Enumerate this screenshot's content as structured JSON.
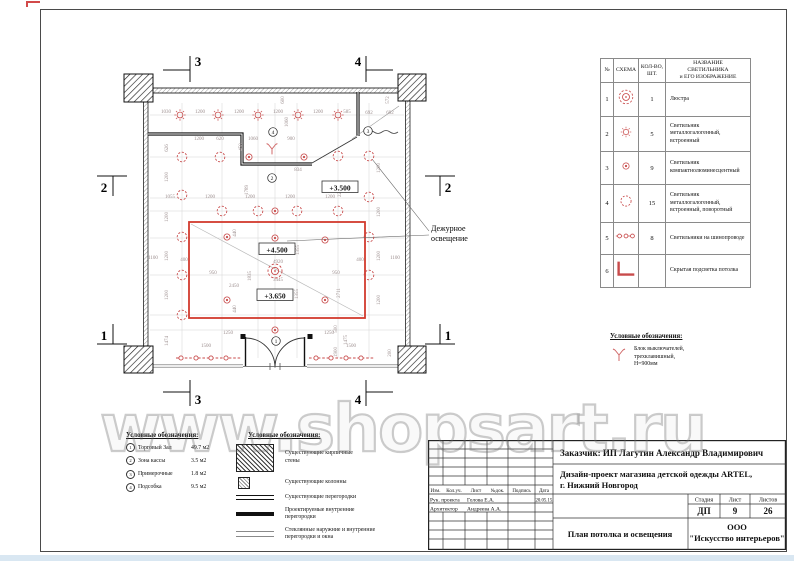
{
  "watermark": {
    "text": "www.shopsart.ru"
  },
  "colors": {
    "light_red": "#c84b4b",
    "cove_red": "#d23a2e",
    "dim_gray": "#9d8f8f",
    "wall_black": "#1a1a1a"
  },
  "plan": {
    "elevations": [
      {
        "t": "+3.500",
        "x": 340,
        "y": 189
      },
      {
        "t": "+4.500",
        "x": 277,
        "y": 251
      },
      {
        "t": "+3.650",
        "x": 275,
        "y": 297
      }
    ],
    "annotation": {
      "lines": [
        "Дежурное",
        "освещение"
      ],
      "x": 431,
      "y": 231
    },
    "room_tags": [
      {
        "n": "4",
        "x": 273,
        "y": 132
      },
      {
        "n": "2",
        "x": 272,
        "y": 178
      },
      {
        "n": "3",
        "x": 368,
        "y": 131
      },
      {
        "n": "1",
        "x": 276,
        "y": 341
      }
    ],
    "section_markers": [
      {
        "label": "3",
        "lines": [
          [
            163,
            70,
            190,
            70
          ],
          [
            190,
            56,
            190,
            82
          ]
        ],
        "tx": 198,
        "ty": 66
      },
      {
        "label": "4",
        "lines": [
          [
            393,
            70,
            366,
            70
          ],
          [
            366,
            56,
            366,
            82
          ]
        ],
        "tx": 358,
        "ty": 66
      },
      {
        "label": "3",
        "lines": [
          [
            163,
            392,
            190,
            392
          ],
          [
            190,
            380,
            190,
            406
          ]
        ],
        "tx": 198,
        "ty": 404
      },
      {
        "label": "4",
        "lines": [
          [
            393,
            392,
            366,
            392
          ],
          [
            366,
            380,
            366,
            406
          ]
        ],
        "tx": 358,
        "ty": 404
      },
      {
        "label": "2",
        "lines": [
          [
            97,
            176,
            127,
            176
          ],
          [
            113,
            176,
            113,
            196
          ]
        ],
        "tx": 104,
        "ty": 192
      },
      {
        "label": "2",
        "lines": [
          [
            425,
            176,
            455,
            176
          ],
          [
            440,
            176,
            440,
            196
          ]
        ],
        "tx": 448,
        "ty": 192
      },
      {
        "label": "1",
        "lines": [
          [
            97,
            344,
            127,
            344
          ],
          [
            113,
            324,
            113,
            344
          ]
        ],
        "tx": 104,
        "ty": 340
      },
      {
        "label": "1",
        "lines": [
          [
            425,
            344,
            455,
            344
          ],
          [
            440,
            324,
            440,
            344
          ]
        ],
        "tx": 448,
        "ty": 340
      }
    ],
    "dims": [
      [
        "1030",
        166,
        113,
        0
      ],
      [
        "1200",
        200,
        113,
        0
      ],
      [
        "1200",
        239,
        113,
        0
      ],
      [
        "1200",
        278,
        113,
        0
      ],
      [
        "1200",
        318,
        113,
        0
      ],
      [
        "585",
        347,
        113,
        0
      ],
      [
        "692",
        369,
        114,
        0
      ],
      [
        "692",
        390,
        114,
        0
      ],
      [
        "572",
        389,
        100,
        1
      ],
      [
        "600",
        284,
        100,
        1
      ],
      [
        "1060",
        288,
        122,
        1
      ],
      [
        "1200",
        199,
        140,
        0
      ],
      [
        "620",
        220,
        140,
        0
      ],
      [
        "450",
        242,
        147,
        1
      ],
      [
        "1060",
        253,
        140,
        0
      ],
      [
        "900",
        291,
        140,
        0
      ],
      [
        "626",
        168,
        148,
        1
      ],
      [
        "834",
        298,
        171,
        0
      ],
      [
        "1789",
        248,
        190,
        1
      ],
      [
        "2286",
        341,
        192,
        1
      ],
      [
        "1055",
        170,
        198,
        0
      ],
      [
        "1200",
        210,
        198,
        0
      ],
      [
        "1200",
        250,
        198,
        0
      ],
      [
        "1200",
        290,
        198,
        0
      ],
      [
        "1200",
        330,
        198,
        0
      ],
      [
        "1200",
        168,
        177,
        1
      ],
      [
        "1200",
        168,
        217,
        1
      ],
      [
        "1200",
        168,
        256,
        1
      ],
      [
        "1200",
        168,
        295,
        1
      ],
      [
        "1474",
        168,
        341,
        1
      ],
      [
        "1100",
        153,
        259,
        0
      ],
      [
        "1100",
        395,
        259,
        0
      ],
      [
        "400",
        184,
        261,
        0
      ],
      [
        "400",
        360,
        261,
        0
      ],
      [
        "1200",
        380,
        168,
        1
      ],
      [
        "1200",
        380,
        212,
        1
      ],
      [
        "1200",
        380,
        256,
        1
      ],
      [
        "1200",
        380,
        300,
        1
      ],
      [
        "440",
        236,
        233,
        1
      ],
      [
        "1355",
        299,
        250,
        1
      ],
      [
        "4920",
        278,
        263,
        0
      ],
      [
        "3445",
        278,
        281,
        0
      ],
      [
        "950",
        213,
        274,
        0
      ],
      [
        "1835",
        251,
        276,
        1
      ],
      [
        "2450",
        234,
        287,
        0
      ],
      [
        "950",
        336,
        274,
        0
      ],
      [
        "1355",
        298,
        294,
        1
      ],
      [
        "2711",
        340,
        293,
        1
      ],
      [
        "440",
        236,
        309,
        1
      ],
      [
        "1250",
        228,
        334,
        0
      ],
      [
        "1500",
        206,
        347,
        0
      ],
      [
        "1250",
        329,
        334,
        0
      ],
      [
        "1500",
        351,
        347,
        0
      ],
      [
        "1900",
        337,
        352,
        1
      ],
      [
        "1475",
        347,
        340,
        1
      ],
      [
        "200",
        391,
        353,
        1
      ],
      [
        "500",
        337,
        329,
        1
      ]
    ],
    "lights": {
      "chandelier": [
        [
          275,
          271
        ]
      ],
      "mh_recessed": [
        [
          180,
          115
        ],
        [
          218,
          115
        ],
        [
          258,
          115
        ],
        [
          298,
          115
        ],
        [
          338,
          115
        ]
      ],
      "compact_fluorescent": [
        [
          227,
          237
        ],
        [
          325,
          240
        ],
        [
          227,
          300
        ],
        [
          325,
          300
        ],
        [
          275,
          238
        ],
        [
          275,
          330
        ],
        [
          249,
          157
        ],
        [
          304,
          157
        ],
        [
          275,
          211
        ]
      ],
      "mh_rotatable": [
        [
          182,
          157
        ],
        [
          220,
          157
        ],
        [
          338,
          156
        ],
        [
          369,
          156
        ],
        [
          182,
          195
        ],
        [
          369,
          197
        ],
        [
          222,
          211
        ],
        [
          258,
          211
        ],
        [
          297,
          211
        ],
        [
          338,
          211
        ],
        [
          182,
          237
        ],
        [
          369,
          237
        ],
        [
          182,
          275
        ],
        [
          369,
          275
        ],
        [
          182,
          315
        ]
      ],
      "tracks": [
        {
          "x1": 176,
          "x2": 241,
          "y": 358,
          "cx": [
            181,
            196,
            211,
            226
          ]
        },
        {
          "x1": 309,
          "x2": 375,
          "y": 358,
          "cx": [
            316,
            331,
            346,
            361
          ]
        }
      ],
      "switch_pos": {
        "x": 272,
        "y": 149
      }
    }
  },
  "fixtures_table": {
    "col_headers": [
      "№",
      "СХЕМА",
      "КОЛ-ВО,\nШТ.",
      "НАЗВАНИЕ\nСВЕТИЛЬНИКА\nи ЕГО ИЗОБРАЖЕНИЕ"
    ],
    "rows": [
      {
        "no": "1",
        "icon": "chandelier-icon",
        "qty": "1",
        "name": "Люстра"
      },
      {
        "no": "2",
        "icon": "recessed-light-icon",
        "qty": "5",
        "name": "Светильник металлогалогенный, встроенный"
      },
      {
        "no": "3",
        "icon": "compact-fluorescent-icon",
        "qty": "9",
        "name": "Светильник компактнолюминесцентный"
      },
      {
        "no": "4",
        "icon": "rotatable-light-icon",
        "qty": "15",
        "name": "Светильник металлогалогенный, встроенный, поворотный"
      },
      {
        "no": "5",
        "icon": "track-lights-icon",
        "qty": "8",
        "name": "Светильники на шинопроводе"
      },
      {
        "no": "6",
        "icon": "cove-lighting-icon",
        "qty": "",
        "name": "Скрытая подсветка потолка"
      }
    ]
  },
  "legend_switch": {
    "title": "Условные обозначения:",
    "items": [
      {
        "icon": "switch-icon",
        "label": "Блок выключателей,\nтрехклавишный,\nН=900мм"
      }
    ]
  },
  "legend_rooms": {
    "title": "Условные обозначения:",
    "items": [
      {
        "no": "1",
        "name": "Торговый Зал",
        "area": "49.7 м2"
      },
      {
        "no": "2",
        "name": "Зона кассы",
        "area": "3.5 м2"
      },
      {
        "no": "3",
        "name": "Примерочные",
        "area": "1.8 м2"
      },
      {
        "no": "4",
        "name": "Подсобка",
        "area": "9.5 м2"
      }
    ]
  },
  "legend_walls": {
    "title": "Условные обозначения:",
    "items": [
      {
        "icon": "brick-wall-icon",
        "label": "Существующие кирпичные\nстены"
      },
      {
        "icon": "column-icon",
        "label": "Существующие колонны"
      },
      {
        "icon": "existing-partition-icon",
        "label": "Существующие перегородки"
      },
      {
        "icon": "new-partition-icon",
        "label": "Проектируемые внутренние\nперегородки"
      },
      {
        "icon": "glass-partition-icon",
        "label": "Стеклянные наружние и внутренние\nперегородки и окна"
      }
    ]
  },
  "title_block": {
    "customer": "Заказчик:  ИП Лагутин Александр Владимирович",
    "project_line1": "Дизайн-проект магазина детской одежды ARTEL,",
    "project_line2": "г. Нижний Новгород",
    "rev_headers": [
      "Изм.",
      "Кол.уч.",
      "Лист",
      "№док.",
      "Подпись",
      "Дата"
    ],
    "signature_rows": [
      {
        "role": "Рук. проекта",
        "name": "Голова Е.А.",
        "date": "20.05.15."
      },
      {
        "role": "Архитектор",
        "name": "Андреева А.А.",
        "date": ""
      }
    ],
    "stage_label": "Стадия",
    "sheet_label": "Лист",
    "sheets_label": "Листов",
    "stage": "ДП",
    "sheet": "9",
    "sheets": "26",
    "drawing_title": "План потолка и освещения",
    "company_line1": "ООО",
    "company_line2": "\"Искусство интерьеров\""
  }
}
